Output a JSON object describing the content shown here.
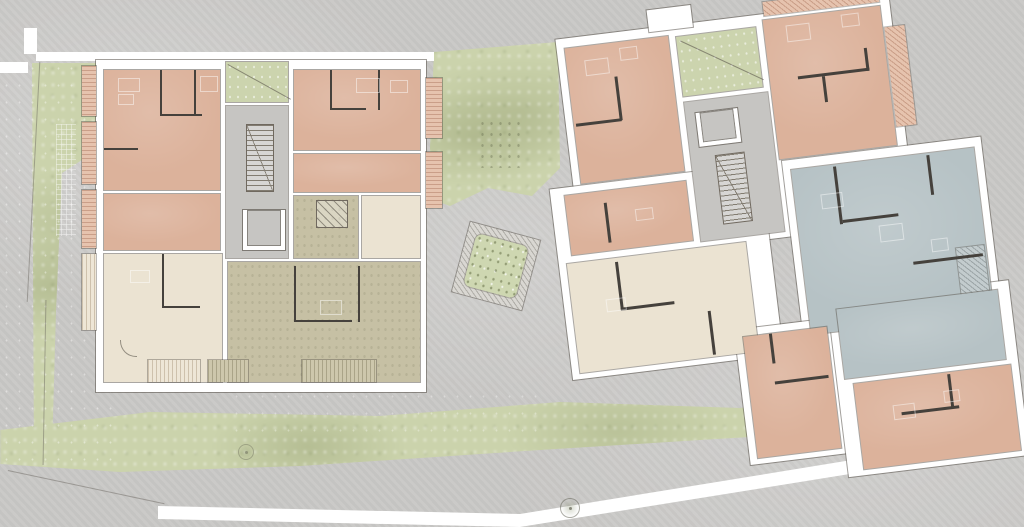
{
  "title": "Residential site plan - ground floor with two apartment buildings",
  "palette": {
    "bg": "#c9c8c6",
    "path": "#ffffff",
    "wall": "#ffffff",
    "partition": "#45413c",
    "terracotta": "#dcb29b",
    "terracotta_light": "#e6c3ae",
    "cream": "#ebe3d2",
    "khaki": "#c6c0a4",
    "bluegray": "#b6c2c5",
    "core": "#c6c5c2",
    "entry_green": "#ccd4ae",
    "green": "#cbd3ac",
    "planter_green": "#ced7b1",
    "hatch_gray": "#b0aea8",
    "stair_line": "#827c71"
  },
  "site": {
    "ground": "concrete plaza",
    "sidewalks": [
      "top sidewalk",
      "bottom sidewalk",
      "east building edge path"
    ],
    "green_areas": [
      "west boundary strip",
      "central garden between buildings",
      "south lawn band"
    ],
    "courtyard_planter": {
      "shape": "rotated square",
      "rotation_deg": 15,
      "border": "paver hatch",
      "fill": "planting"
    },
    "trees": 2,
    "trellis": "paving grid at west edge"
  },
  "buildings": {
    "west": {
      "orientation_deg": 0,
      "core": {
        "entry_garden": true,
        "stair": true,
        "elevator": true,
        "winder_stair": true
      },
      "apartments": [
        {
          "id": "nw",
          "color": "terracotta"
        },
        {
          "id": "w",
          "color": "terracotta"
        },
        {
          "id": "sw",
          "color": "cream"
        },
        {
          "id": "ne",
          "color": "terracotta"
        },
        {
          "id": "e",
          "color": "terracotta"
        },
        {
          "id": "se",
          "color": "khaki"
        },
        {
          "id": "s-hall",
          "color": "cream"
        }
      ],
      "balconies_west": 4,
      "balconies_east": 2,
      "terraces_south": 3
    },
    "east": {
      "orientation_deg": -7,
      "core": {
        "entry_garden": true,
        "stair": true,
        "elevator": true
      },
      "apartments": [
        {
          "id": "nw",
          "color": "terracotta"
        },
        {
          "id": "ne",
          "color": "terracotta"
        },
        {
          "id": "w",
          "color": "terracotta"
        },
        {
          "id": "sw",
          "color": "cream"
        },
        {
          "id": "e",
          "color": "bluegray"
        },
        {
          "id": "s",
          "color": "terracotta"
        },
        {
          "id": "se-upper",
          "color": "bluegray"
        },
        {
          "id": "se",
          "color": "terracotta"
        }
      ],
      "balcony_hatches": [
        "top edge",
        "northeast corner wedge",
        "east edge"
      ]
    }
  }
}
